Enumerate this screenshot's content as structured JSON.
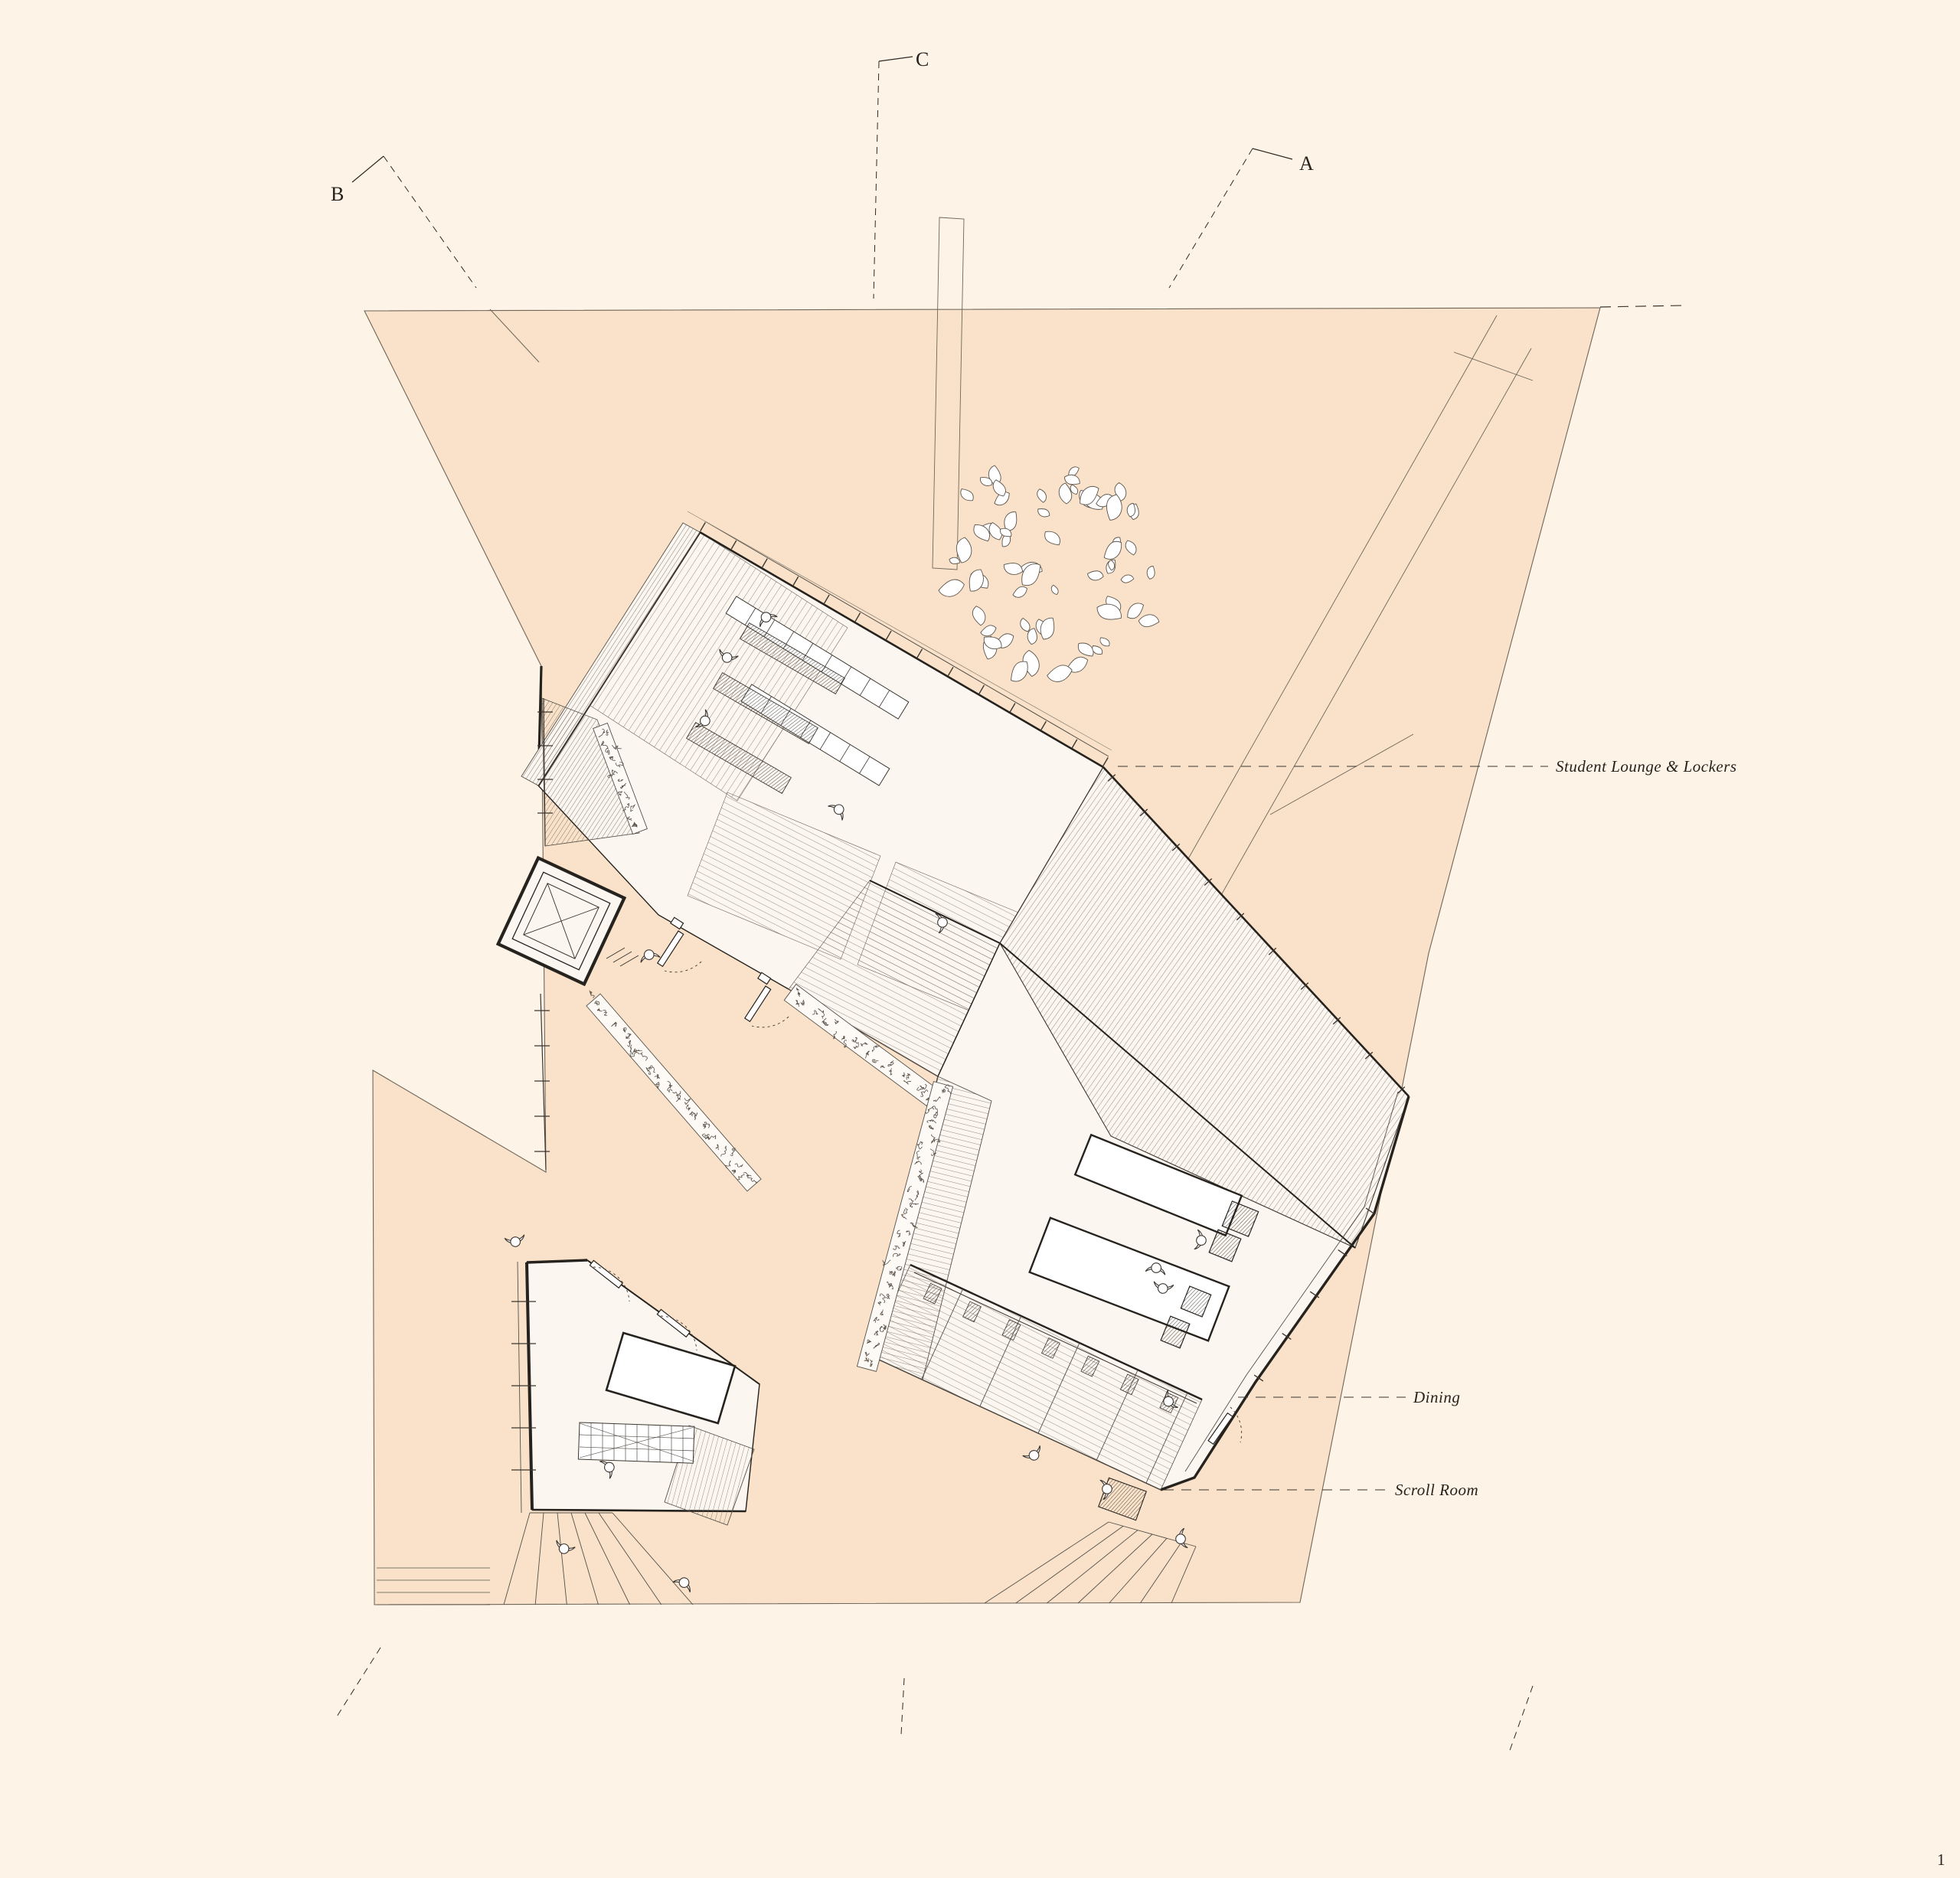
{
  "drawing": {
    "section_markers": {
      "a": "A",
      "b": "B",
      "c": "C"
    },
    "labels": {
      "student_lounge": "Student Lounge & Lockers",
      "dining": "Dining",
      "scroll_room": "Scroll Room"
    },
    "page_number": "1",
    "colors": {
      "background": "#fdf3e6",
      "site": "#f9e2c9",
      "building": "#fbf7f0",
      "line": "#2f2a25",
      "hatch": "#6e6257"
    }
  }
}
